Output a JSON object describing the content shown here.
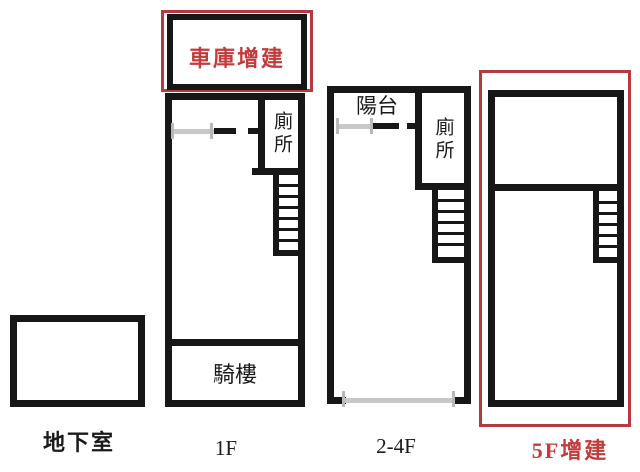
{
  "labels": {
    "garage": "車庫增建",
    "toilet_1f": "廁所",
    "arcade_1f": "騎樓",
    "balcony_24f": "陽台",
    "toilet_24f": "廁所",
    "basement": "地下室",
    "floor_1": "1F",
    "floor_2_4": "2-4F",
    "floor_5": "5F增建"
  },
  "colors": {
    "wall_black": "#171717",
    "annotation_red": "#b53a3e",
    "red_text": "#c43b3b",
    "window_gray": "#c8c8c8",
    "background": "#ffffff"
  }
}
